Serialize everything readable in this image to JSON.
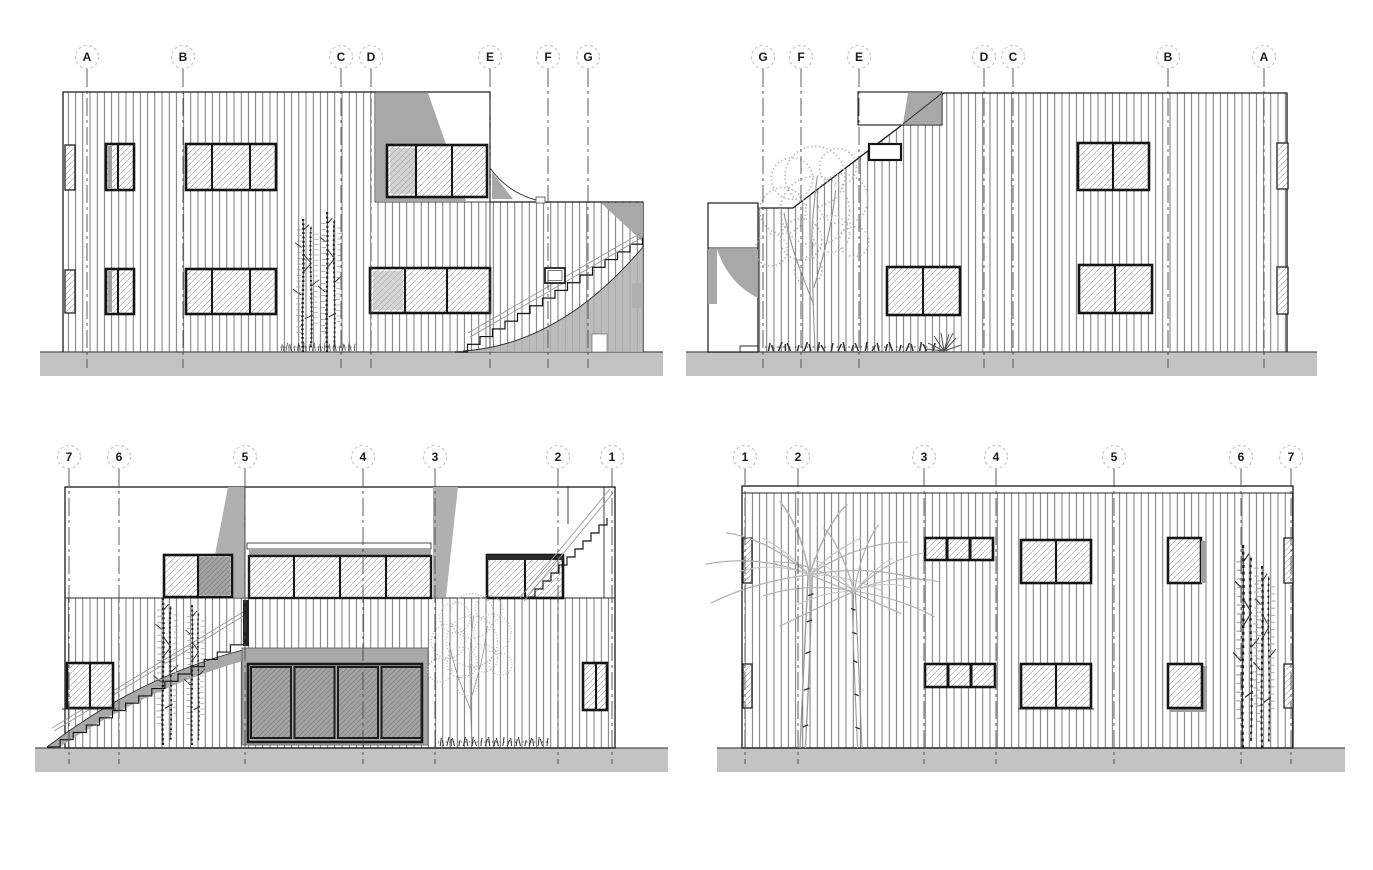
{
  "sheet": {
    "kind": "architectural elevation drawings",
    "views": "4 exterior elevations arranged in a 2x2 grid"
  },
  "views": [
    {
      "id": "elevation-top-left",
      "markers": [
        "A",
        "B",
        "C",
        "D",
        "E",
        "F",
        "G"
      ]
    },
    {
      "id": "elevation-top-right",
      "markers": [
        "G",
        "F",
        "E",
        "D",
        "C",
        "B",
        "A"
      ]
    },
    {
      "id": "elevation-bottom-left",
      "markers": [
        "7",
        "6",
        "5",
        "4",
        "3",
        "2",
        "1"
      ]
    },
    {
      "id": "elevation-bottom-right",
      "markers": [
        "1",
        "2",
        "3",
        "4",
        "5",
        "6",
        "7"
      ]
    }
  ],
  "colors": {
    "paper": "#ffffff",
    "line": "#1a1a1a",
    "ground_band": "#c3c3c3",
    "shadow_gray": "#a8a8a8",
    "door_glass_gray": "#a2a2a2",
    "marker_ring": "#c2c2c2",
    "glass_hatch": "#9d9d9d",
    "vegetation_gray": "#b4b4b4"
  }
}
